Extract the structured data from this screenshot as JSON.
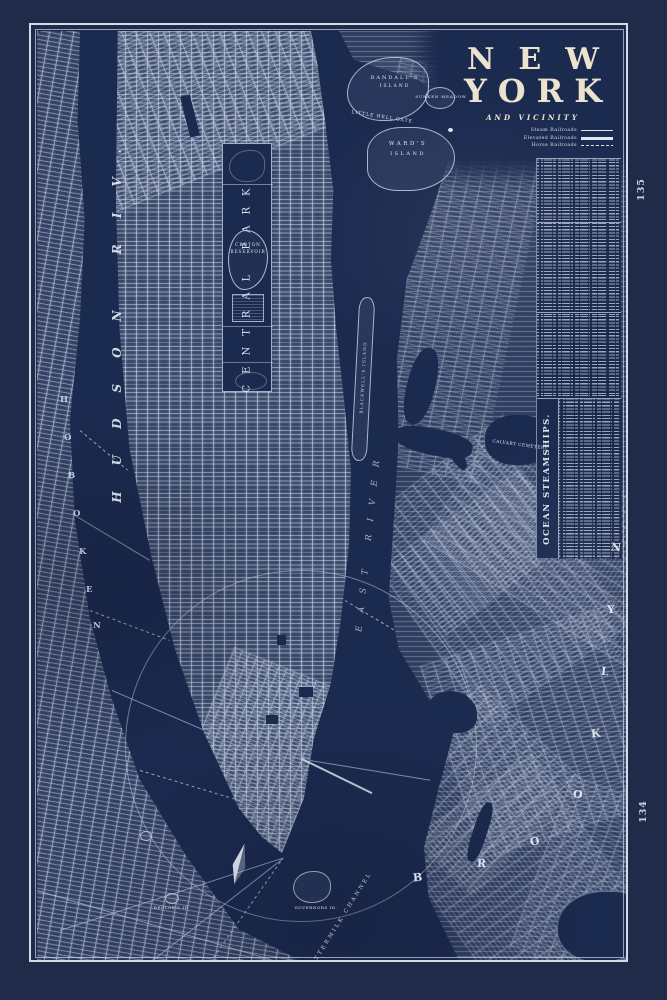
{
  "colors": {
    "margin": "#202b4a",
    "plate": "#1b2a4f",
    "line": "#c7d2e4",
    "cream": "#ece3cd"
  },
  "title": {
    "line1": "NEW",
    "line2": "YORK",
    "subtitle": "AND VICINITY"
  },
  "legend": {
    "items": [
      {
        "label": "Steam Railroads",
        "style": "thin"
      },
      {
        "label": "Elevated Railroads",
        "style": "thick"
      },
      {
        "label": "Horse Railroads",
        "style": "dashed"
      }
    ]
  },
  "page_numbers": {
    "top": "135",
    "bottom": "134"
  },
  "index_panel": {
    "heading": "OCEAN STEAMSHIPS."
  },
  "labels": {
    "hudson": "HUDSON RIV.",
    "east_river": "EAST RIVER",
    "central_park": "CENTRAL PARK",
    "croton1": "CROTON",
    "croton2": "RESERVOIR",
    "randalls1": "RANDALL'S",
    "randalls2": "ISLAND",
    "wards1": "WARD'S",
    "wards2": "ISLAND",
    "little_hell_gate": "LITTLE HELL GATE",
    "sunken_meadow": "SUNKEN MEADOW",
    "blackwells": "BLACKWELL'S ISLAND",
    "buttermilk": "BUTTERMILK CHANNEL",
    "calvary": "CALVARY CEMETERY",
    "bedloes": "BEDLOE'S ID.",
    "governors": "GOVERNORS ID."
  },
  "letter_scatter": {
    "brooklyn": [
      "B",
      "R",
      "O",
      "O",
      "K",
      "L",
      "Y",
      "N"
    ],
    "hoboken": [
      "H",
      "O",
      "B",
      "O",
      "K",
      "E",
      "N"
    ]
  }
}
